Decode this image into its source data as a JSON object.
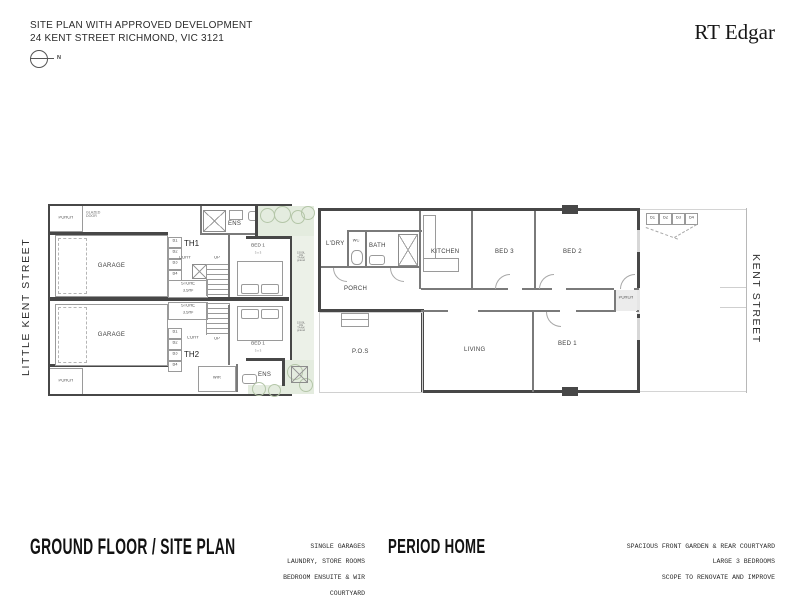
{
  "header": {
    "title_line1": "SITE PLAN WITH APPROVED DEVELOPMENT",
    "title_line2": "24 KENT STREET RICHMOND, VIC 3121",
    "north_label": "N",
    "brand": "RT Edgar"
  },
  "streets": {
    "left": "LITTLE KENT STREET",
    "right": "KENT STREET"
  },
  "bins": [
    "B1",
    "B2",
    "B3",
    "B4"
  ],
  "development": {
    "th1": {
      "name": "TH1",
      "porch": "PORCH",
      "glazed_door": "GLAZED DOOR",
      "garage": "GARAGE",
      "ens": "ENS",
      "ldry": "L'DRY",
      "store_line1": "STORE",
      "store_line2": "3.5m²",
      "up": "UP",
      "bed": "BED 1",
      "bed_size": "3 x 3"
    },
    "th2": {
      "name": "TH2",
      "porch": "PORCH",
      "garage": "GARAGE",
      "ens": "ENS",
      "ldry": "L'DRY",
      "store_line1": "STORE",
      "store_line2": "3.5m²",
      "up": "UP",
      "bed": "BED 1",
      "bed_size": "3 x 3",
      "wir": "WIR"
    },
    "tank_note": [
      "1500L",
      "UG TANK",
      "gravel"
    ]
  },
  "period_home": {
    "ldry": "L'DRY",
    "wc": "WC",
    "bath": "BATH",
    "porch_rear": "PORCH",
    "pos": "P.O.S",
    "kitchen": "KITCHEN",
    "bed3": "BED 3",
    "bed2": "BED 2",
    "living": "LIVING",
    "bed1": "BED 1",
    "porch_front": "PORCH"
  },
  "footer": {
    "left_title": "GROUND FLOOR / SITE PLAN",
    "center_notes": [
      "SINGLE GARAGES",
      "LAUNDRY, STORE ROOMS",
      "BEDROOM ENSUITE & WIR",
      "COURTYARD"
    ],
    "center_title": "PERIOD HOME",
    "right_notes": [
      "SPACIOUS FRONT GARDEN & REAR COURTYARD",
      "LARGE 3 BEDROOMS",
      "SCOPE TO RENOVATE AND IMPROVE"
    ]
  },
  "colors": {
    "wall": "#474747",
    "green": "#e4ecdf",
    "line": "#9a9a9a"
  }
}
